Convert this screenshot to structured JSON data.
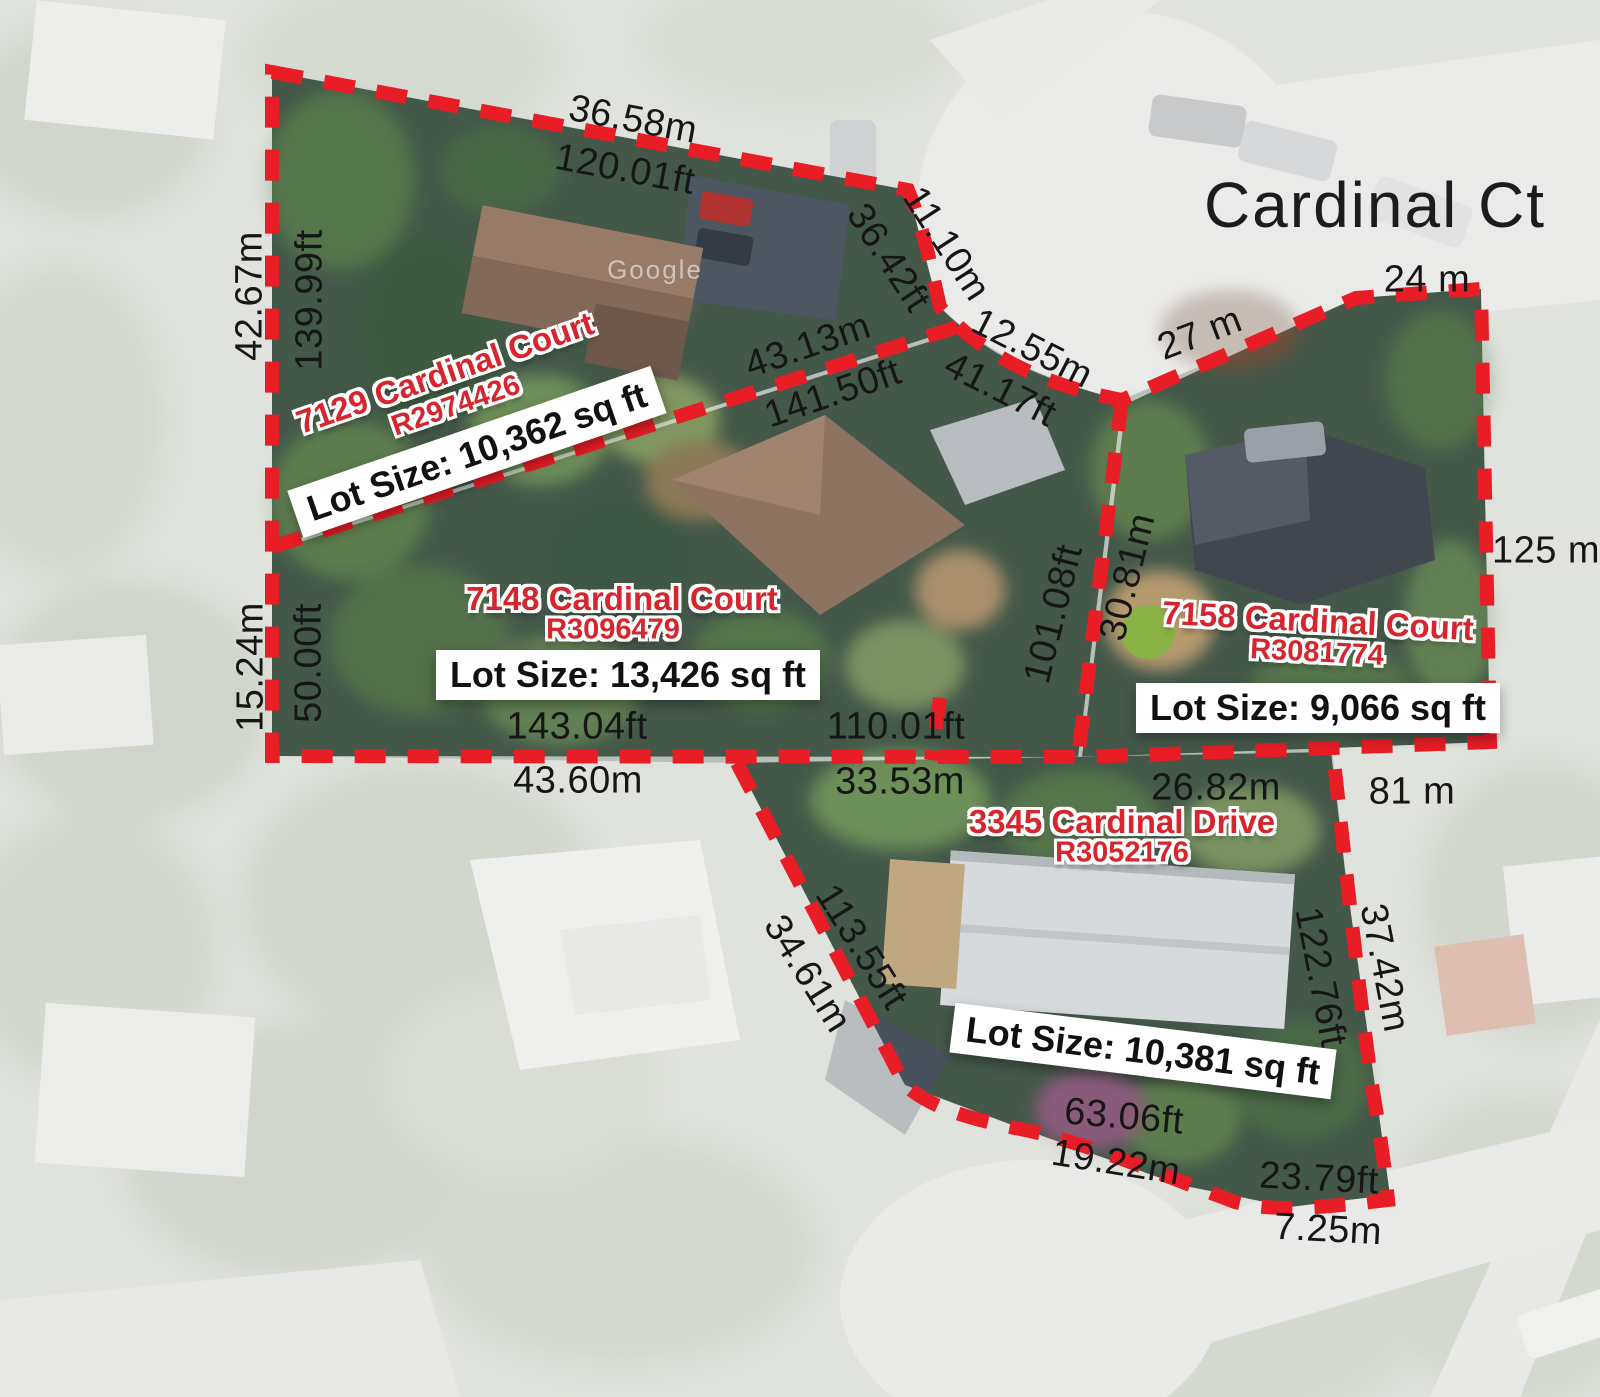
{
  "street_label": "Cardinal Ct",
  "watermark": "Google",
  "lots": [
    {
      "name": "7129 Cardinal Court",
      "mls": "R2974426",
      "size": "Lot Size: 10,362 sq ft",
      "dims": {
        "top_m": "36.58m",
        "top_ft": "120.01ft",
        "left_m": "42.67m",
        "left_ft": "139.99ft",
        "ne_ft": "36.42ft",
        "ne_m": "11.10m",
        "diag_m": "43.13m",
        "diag_ft": "141.50ft",
        "front_m": "12.55m",
        "front_ft": "41.17ft"
      }
    },
    {
      "name": "7148 Cardinal Court",
      "mls": "R3096479",
      "size": "Lot Size: 13,426 sq ft",
      "dims": {
        "left_m": "15.24m",
        "left_ft": "50.00ft",
        "bottom_w_ft": "143.04ft",
        "bottom_w_m": "43.60m",
        "bottom_e_ft": "110.01ft",
        "bottom_e_m": "33.53m",
        "right_ft": "101.08ft",
        "right_m": "30.81m"
      }
    },
    {
      "name": "7158 Cardinal Court",
      "mls": "R3081774",
      "size": "Lot Size: 9,066 sq ft",
      "dims": {
        "top_w": "27 m",
        "top_e": "24 m",
        "right": "125 m",
        "bottom_w": "26.82m",
        "bottom_e": "81 m"
      }
    },
    {
      "name": "3345 Cardinal Drive",
      "mls": "R3052176",
      "size": "Lot Size: 10,381 sq ft",
      "dims": {
        "left_ft": "113.55ft",
        "left_m": "34.61m",
        "right_ft": "122.76ft",
        "right_m": "37.42m",
        "bottom_w_ft": "63.06ft",
        "bottom_w_m": "19.22m",
        "bottom_e_ft": "23.79ft",
        "bottom_e_m": "7.25m"
      }
    }
  ]
}
